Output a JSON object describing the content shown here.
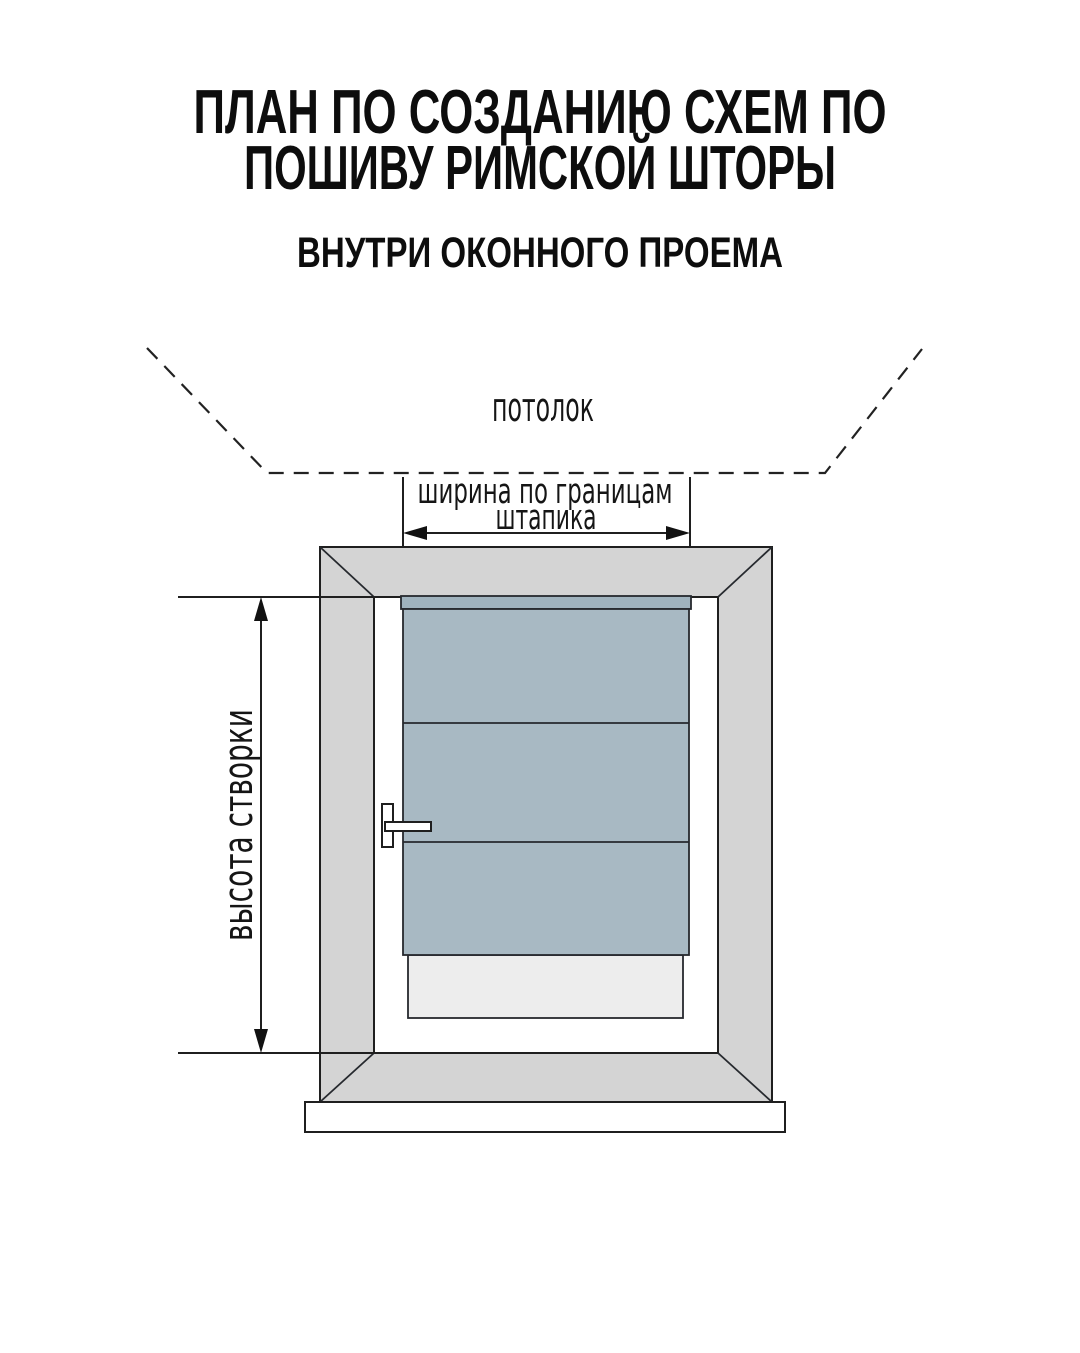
{
  "header": {
    "title_line1": "ПЛАН ПО СОЗДАНИЮ СХЕМ ПО",
    "title_line2": "ПОШИВУ РИМСКОЙ ШТОРЫ",
    "subtitle": "ВНУТРИ ОКОННОГО ПРОЕМА"
  },
  "diagram": {
    "ceiling_label": "потолок",
    "width_dimension": {
      "label_line1": "ширина по границам",
      "label_line2": "штапика"
    },
    "height_dimension": {
      "label": "высота створки"
    },
    "colors": {
      "background": "#ffffff",
      "frame_face": "#d4d4d4",
      "sash_face": "#ffffff",
      "shade_top_band": "#a0b3be",
      "shade_main": "#a8b9c3",
      "glass_below_shade": "#ededed",
      "windowsill": "#ffffff",
      "line": "#1f1f1f",
      "text": "#111111"
    }
  }
}
